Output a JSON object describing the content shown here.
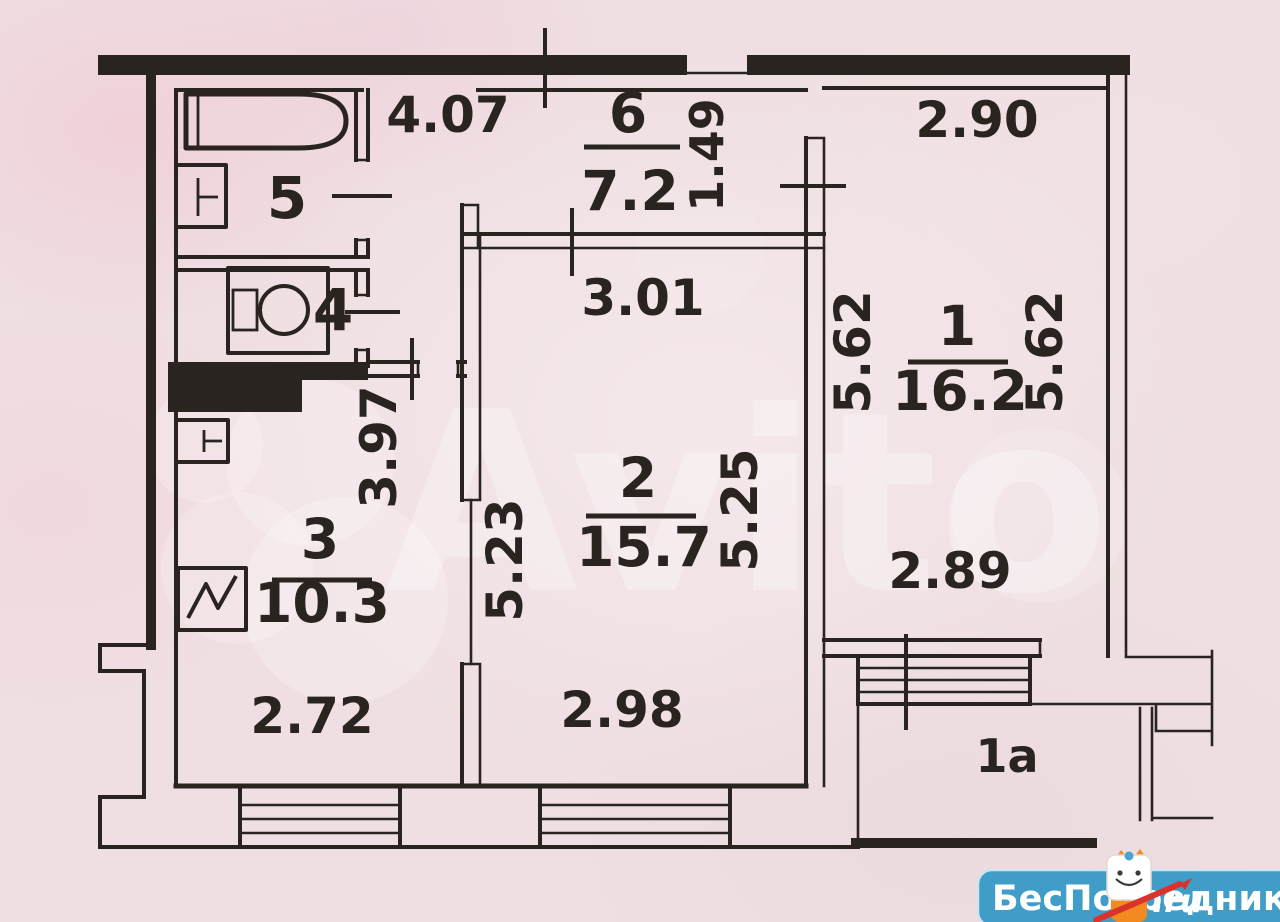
{
  "colors": {
    "paper": "#efdfe2",
    "ink": "#2a2420",
    "watermark": "#ffffff",
    "banner": "#3f9dc7",
    "banner_border": "#cfe4ef",
    "mascot_orange": "#f28a1f",
    "pencil_red": "#d9332b"
  },
  "rooms": {
    "room1": {
      "number": "1",
      "area": "16.2"
    },
    "room2": {
      "number": "2",
      "area": "15.7"
    },
    "room3": {
      "number": "3",
      "area": "10.3"
    },
    "room4": {
      "number": "4"
    },
    "room5": {
      "number": "5"
    },
    "room6": {
      "number": "6",
      "area": "7.2"
    },
    "balcony": {
      "number": "1a"
    }
  },
  "dimensions": {
    "hall_width": "4.07",
    "niche_width": "1.49",
    "room1_width_top": "2.90",
    "room2_width_top": "3.01",
    "room1_height_left": "5.62",
    "room1_height_right": "5.62",
    "room3_height": "3.97",
    "room2_height_left": "5.23",
    "room2_height_right": "5.25",
    "room1_width_bottom": "2.89",
    "room3_width_bottom": "2.72",
    "room2_width_bottom": "2.98"
  },
  "watermarks": {
    "avito_text": "Avito",
    "banner_text": "БесПосредника",
    "banner_suffix": ".ru"
  }
}
